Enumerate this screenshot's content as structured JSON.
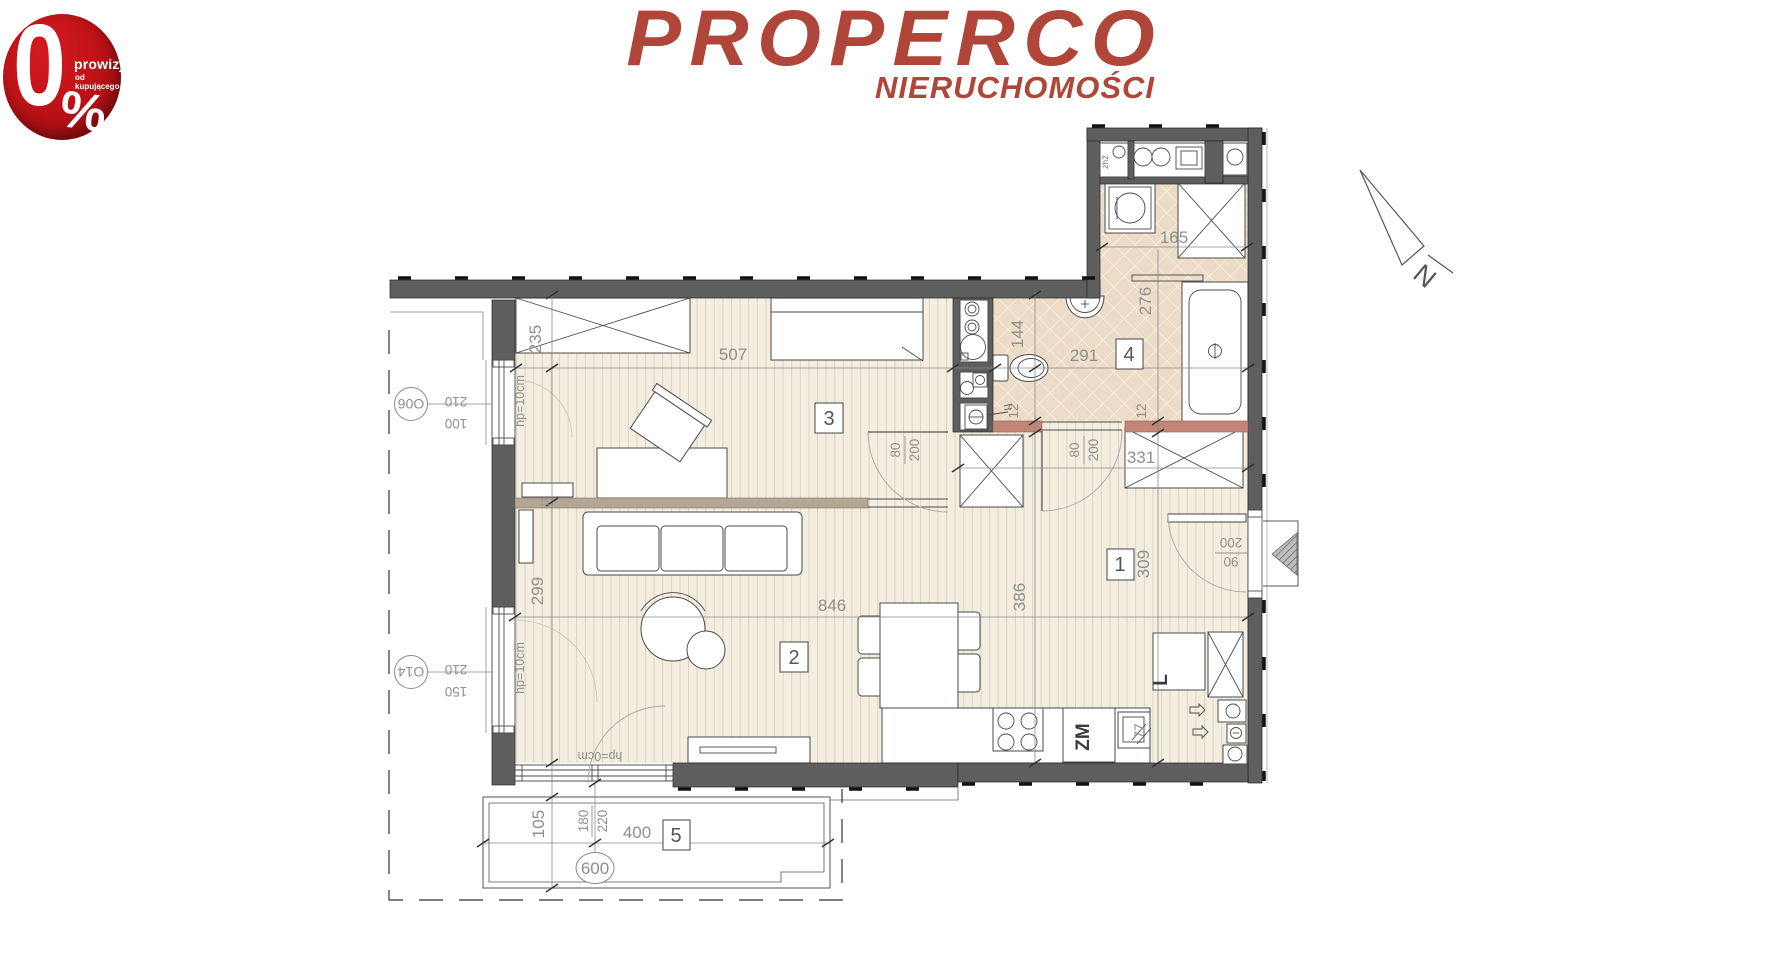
{
  "badge": {
    "zero": "0",
    "percent": "%",
    "line1": "prowizji",
    "line2": "od kupującego"
  },
  "logo": {
    "name": "PROPERCO",
    "subtitle": "NIERUCHOMOŚCI",
    "brand_color": "#b0463a"
  },
  "compass": {
    "north": "N"
  },
  "room_labels": {
    "r1": "1",
    "r2": "2",
    "r3": "3",
    "r4": "4",
    "r5": "5"
  },
  "dimensions": {
    "d235": "235",
    "d507": "507",
    "d299": "299",
    "d846": "846",
    "d105": "105",
    "d400": "400",
    "d600": "600",
    "d386": "386",
    "d309": "309",
    "d331": "331",
    "d144": "144",
    "d291": "291",
    "d276": "276",
    "d165": "165",
    "d12a": "12",
    "d12b": "12",
    "d11": "11",
    "d77": "77"
  },
  "doors": {
    "room3": {
      "num": "80",
      "den": "200"
    },
    "bath": {
      "num": "80",
      "den": "200"
    },
    "entrance": {
      "num": "90",
      "den": "200"
    },
    "balcony": {
      "num": "180",
      "den": "220"
    }
  },
  "windows": {
    "w1": {
      "code": "O06",
      "width": "210",
      "sill": "100",
      "hp": "hp=10cm"
    },
    "w2": {
      "code": "O14",
      "width": "210",
      "sill": "150",
      "hp": "hp=10cm"
    },
    "balcony_hp": "hp=0cm"
  },
  "kitchen": {
    "sink_label": "ZM",
    "fridge_label": "L"
  },
  "utility": {
    "shaft_label": "zh2"
  },
  "colors": {
    "wall": "#5e5e5e",
    "tile": "#ecdbc6",
    "wood": "#f4eee1",
    "lintel": "#c28677",
    "partition": "#b3a694"
  }
}
